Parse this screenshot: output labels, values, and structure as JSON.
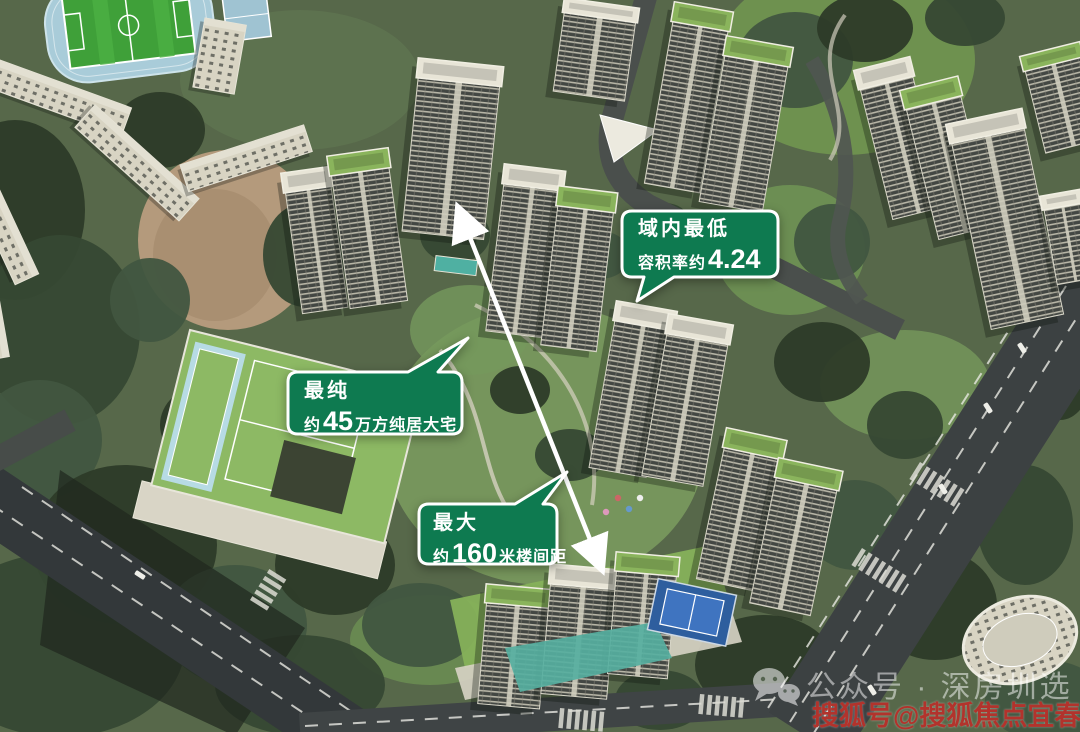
{
  "callouts": [
    {
      "id": "plot-ratio",
      "title": "域内最低",
      "line2_prefix": "容积率约",
      "line2_value": "4.24",
      "line2_suffix": ""
    },
    {
      "id": "purity",
      "title": "最纯",
      "line2_prefix": "约",
      "line2_value": "45",
      "line2_suffix": "万方纯居大宅"
    },
    {
      "id": "spacing",
      "title": "最大",
      "line2_prefix": "约",
      "line2_value": "160",
      "line2_suffix": "米楼间距"
    }
  ],
  "watermarks": {
    "wechat_label": "公众号 · 深房圳选",
    "sohu_label": "搜狐号@搜狐焦点宜春站"
  },
  "icons": {
    "wechat": "wechat-icon",
    "arrow": "double-headed-distance-arrow"
  },
  "colors": {
    "callout_green": "#0e7a50",
    "callout_border": "#ffffff",
    "sohu_red": "#b2332c",
    "watermark_white": "rgba(255,255,255,0.5)"
  }
}
